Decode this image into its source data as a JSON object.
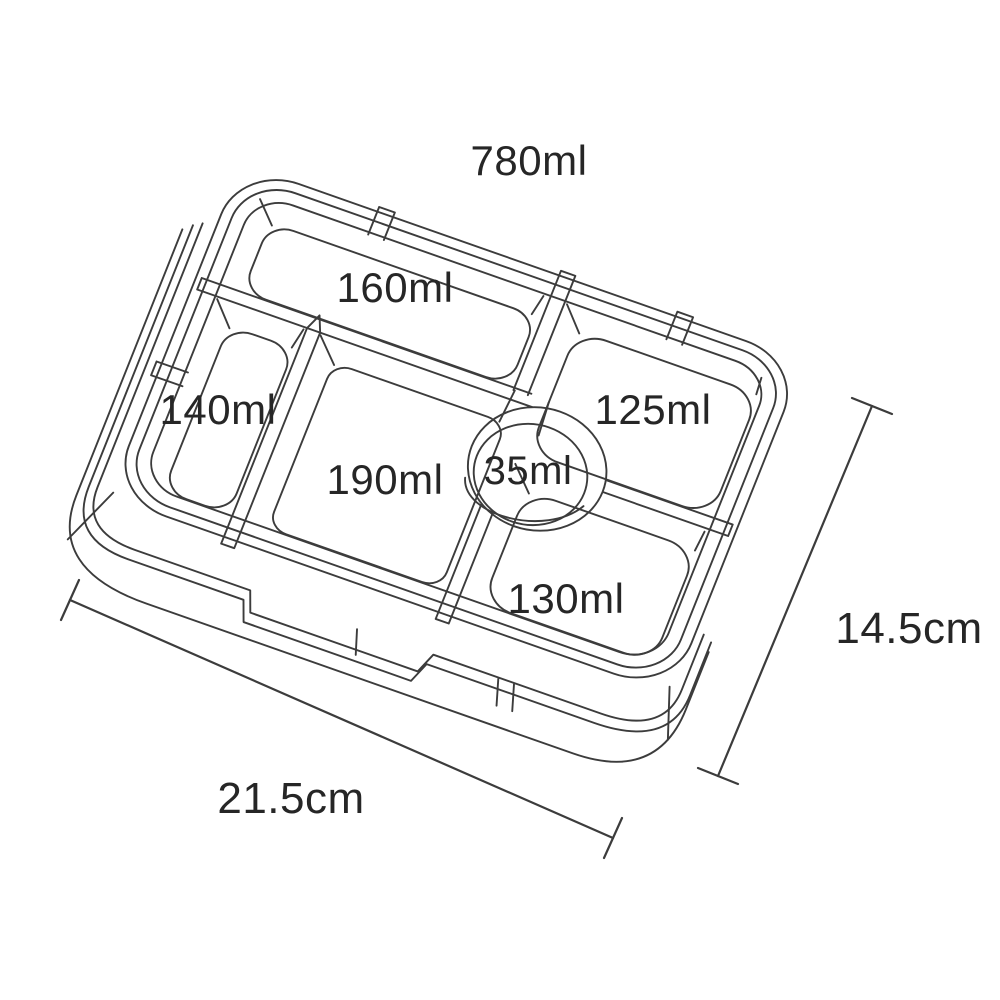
{
  "diagram": {
    "total_capacity": "780ml",
    "compartments": [
      {
        "position": "top",
        "label": "160ml"
      },
      {
        "position": "left",
        "label": "140ml"
      },
      {
        "position": "right",
        "label": "125ml"
      },
      {
        "position": "center",
        "label": "190ml"
      },
      {
        "position": "dip-well",
        "label": "35ml"
      },
      {
        "position": "bottom",
        "label": "130ml"
      }
    ],
    "dimensions": {
      "width": "21.5cm",
      "depth": "14.5cm"
    },
    "colors": {
      "line": "#3c3c3c",
      "text": "#262626",
      "background": "#ffffff"
    }
  }
}
